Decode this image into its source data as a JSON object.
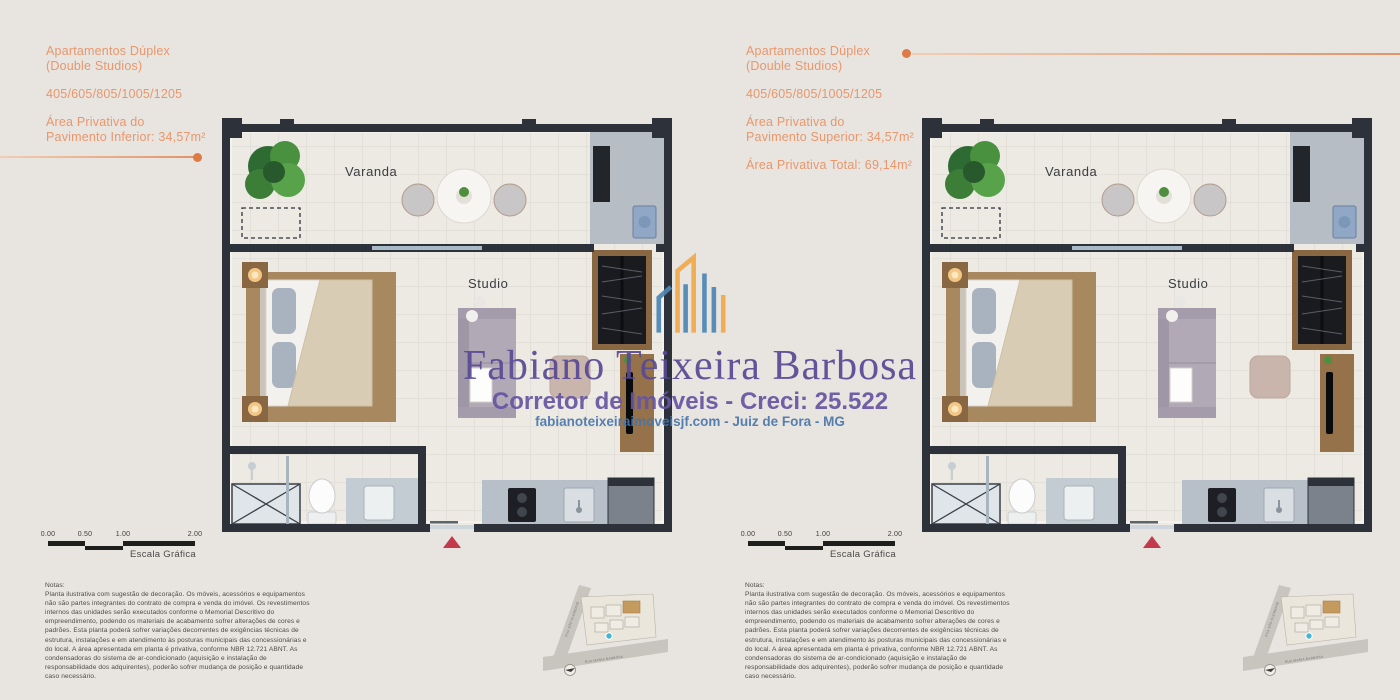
{
  "watermark": {
    "name": "Fabiano Teixeira Barbosa",
    "subtitle": "Corretor de Imóveis - Creci: 25.522",
    "website_line": "fabianoteixeiraimoveisjf.com - Juiz de Fora - MG",
    "name_color": "#584994",
    "website_color": "#4675ab"
  },
  "left_panel": {
    "title_line1": "Apartamentos Dúplex",
    "title_line2": "(Double Studios)",
    "units_line": "405/605/805/1005/1205",
    "area_line1": "Área Privativa do",
    "area_line2": "Pavimento Inferior: 34,57m²"
  },
  "right_panel": {
    "title_line1": "Apartamentos Dúplex",
    "title_line2": "(Double Studios)",
    "units_line": "405/605/805/1005/1205",
    "area_line1": "Área Privativa do",
    "area_line2": "Pavimento Superior: 34,57m²",
    "area_total": "Área Privativa Total: 69,14m²"
  },
  "floor_plan": {
    "varanda_label": "Varanda",
    "studio_label": "Studio"
  },
  "scale_bar": {
    "ticks": [
      "0.00",
      "0.50",
      "1.00",
      "2.00"
    ],
    "label": "Escala Gráfica"
  },
  "notes": {
    "heading": "Notas:",
    "body": "Planta ilustrativa com sugestão de decoração. Os móveis, acessórios e equipamentos não são partes integrantes do contrato de compra e venda do imóvel. Os revestimentos internos das unidades serão executados conforme o Memorial Descritivo do empreendimento, podendo os materiais de acabamento sofrer alterações de cores e padrões. Esta planta poderá sofrer variações decorrentes de exigências técnicas de estrutura, instalações e em atendimento às posturas municipais das concessionárias e do local. A área apresentada em planta é privativa, conforme NBR 12.721 ABNT. As condensadoras do sistema de ar-condicionado (aquisição e instalação de responsabilidade dos adquirentes), poderão sofrer mudança de posição e quantidade caso necessário."
  },
  "site_map": {
    "street_diagonal": "RUA SÃO CLEMENTE",
    "street_bottom": "RUA MARIA BARBOSA"
  },
  "colors": {
    "accent_orange": "#e9976c",
    "accent_dot": "#dd7a45",
    "background": "#e8e4df",
    "wall": "#2d323a",
    "entrance_marker_red": "#c23a4b",
    "highlight_unit_tan": "#c49a5f"
  }
}
